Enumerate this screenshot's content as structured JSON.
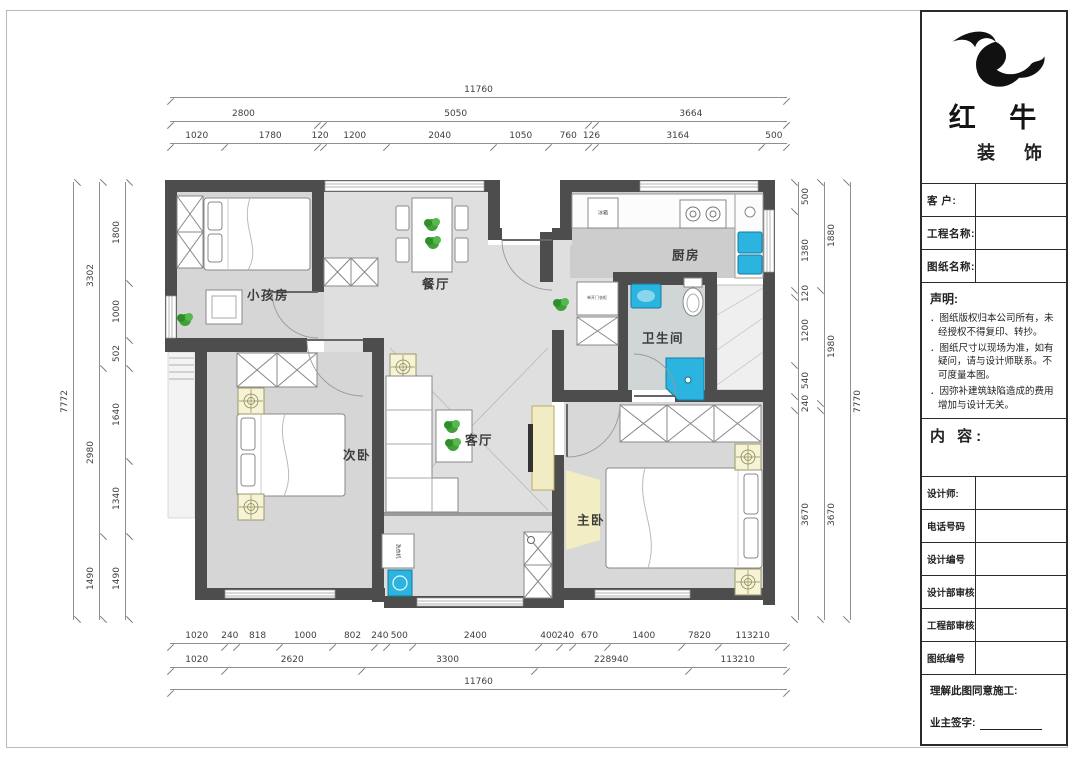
{
  "company": {
    "brand_line1": "红 牛",
    "brand_line2": "装 饰"
  },
  "title_block": {
    "rows": [
      {
        "label": "客  户:"
      },
      {
        "label": "工程名称:"
      },
      {
        "label": "图纸名称:"
      }
    ],
    "statement": {
      "title": "声明:",
      "items": [
        "图纸版权归本公司所有，未经授权不得复印、转抄。",
        "图纸尺寸以现场为准，如有疑问，请与设计师联系。不可度量本图。",
        "因弥补建筑缺陷造成的费用增加与设计无关。"
      ]
    },
    "content_label": "内 容:",
    "info_rows": [
      {
        "label": "设计师:"
      },
      {
        "label": "电话号码"
      },
      {
        "label": "设计编号"
      },
      {
        "label": "设计部审核"
      },
      {
        "label": "工程部审核"
      },
      {
        "label": "图纸编号"
      }
    ],
    "footer": {
      "agree": "理解此图同意施工:",
      "sign": "业主签字:"
    }
  },
  "plan": {
    "rooms": [
      {
        "name": "小孩房"
      },
      {
        "name": "餐厅"
      },
      {
        "name": "厨房"
      },
      {
        "name": "卫生间"
      },
      {
        "name": "次卧"
      },
      {
        "name": "客厅"
      },
      {
        "name": "主卧"
      }
    ],
    "fixture_labels": {
      "washer": "洗衣机",
      "fridge": "冰箱",
      "closet": "单开门衣柜"
    },
    "colors": {
      "wall": "#4d4d4d",
      "floor": "#dedede",
      "fixture_cyan": "#2ab4df",
      "symbol_yellow": "#f7f3d6",
      "plant_green": "#3fa138"
    }
  },
  "dims": {
    "top_total": [
      {
        "size": 11760,
        "label": "11760"
      }
    ],
    "top_mid": [
      {
        "size": 2800,
        "label": "2800"
      },
      {
        "size": 120,
        "label": ""
      },
      {
        "size": 5050,
        "label": "5050"
      },
      {
        "size": 126,
        "label": ""
      },
      {
        "size": 3664,
        "label": "3664"
      }
    ],
    "top_inner": [
      {
        "size": 1020,
        "label": "1020"
      },
      {
        "size": 1780,
        "label": "1780"
      },
      {
        "size": 120,
        "label": "120"
      },
      {
        "size": 1200,
        "label": "1200"
      },
      {
        "size": 2040,
        "label": "2040"
      },
      {
        "size": 1050,
        "label": "1050"
      },
      {
        "size": 760,
        "label": "760"
      },
      {
        "size": 126,
        "label": "126"
      },
      {
        "size": 3164,
        "label": "3164"
      },
      {
        "size": 500,
        "label": "500"
      }
    ],
    "left_outer": [
      {
        "size": 7772,
        "label": "7772"
      }
    ],
    "left_mid": [
      {
        "size": 3302,
        "label": "3302"
      },
      {
        "size": 2980,
        "label": "2980"
      },
      {
        "size": 1490,
        "label": "1490"
      }
    ],
    "left_inner": [
      {
        "size": 1800,
        "label": "1800"
      },
      {
        "size": 1000,
        "label": "1000"
      },
      {
        "size": 502,
        "label": "502"
      },
      {
        "size": 1640,
        "label": "1640"
      },
      {
        "size": 1340,
        "label": "1340"
      },
      {
        "size": 1490,
        "label": "1490"
      }
    ],
    "right_inner": [
      {
        "size": 500,
        "label": "500"
      },
      {
        "size": 1380,
        "label": "1380"
      },
      {
        "size": 120,
        "label": "120"
      },
      {
        "size": 1200,
        "label": "1200"
      },
      {
        "size": 540,
        "label": "540"
      },
      {
        "size": 240,
        "label": "240"
      },
      {
        "size": 3670,
        "label": "3670"
      }
    ],
    "right_mid": [
      {
        "size": 1880,
        "label": "1880"
      },
      {
        "size": 1980,
        "label": "1980"
      },
      {
        "size": 120,
        "label": ""
      },
      {
        "size": 3670,
        "label": "3670"
      }
    ],
    "right_outer": [
      {
        "size": 7770,
        "label": "7770"
      }
    ],
    "bottom_inner": [
      {
        "size": 1020,
        "label": "1020"
      },
      {
        "size": 240,
        "label": "240"
      },
      {
        "size": 818,
        "label": "818"
      },
      {
        "size": 1000,
        "label": "1000"
      },
      {
        "size": 802,
        "label": "802"
      },
      {
        "size": 240,
        "label": "240"
      },
      {
        "size": 500,
        "label": "500"
      },
      {
        "size": 2400,
        "label": "2400"
      },
      {
        "size": 400,
        "label": "400"
      },
      {
        "size": 240,
        "label": "240"
      },
      {
        "size": 670,
        "label": "670"
      },
      {
        "size": 1400,
        "label": "1400"
      },
      {
        "size": 720,
        "label": "7820"
      },
      {
        "size": 1310,
        "label": "113210"
      }
    ],
    "bottom_mid": [
      {
        "size": 1020,
        "label": "1020"
      },
      {
        "size": 2620,
        "label": "2620"
      },
      {
        "size": 3300,
        "label": "3300"
      },
      {
        "size": 2940,
        "label": "228940"
      },
      {
        "size": 1880,
        "label": "113210"
      }
    ],
    "bottom_total": [
      {
        "size": 11760,
        "label": "11760"
      }
    ]
  }
}
